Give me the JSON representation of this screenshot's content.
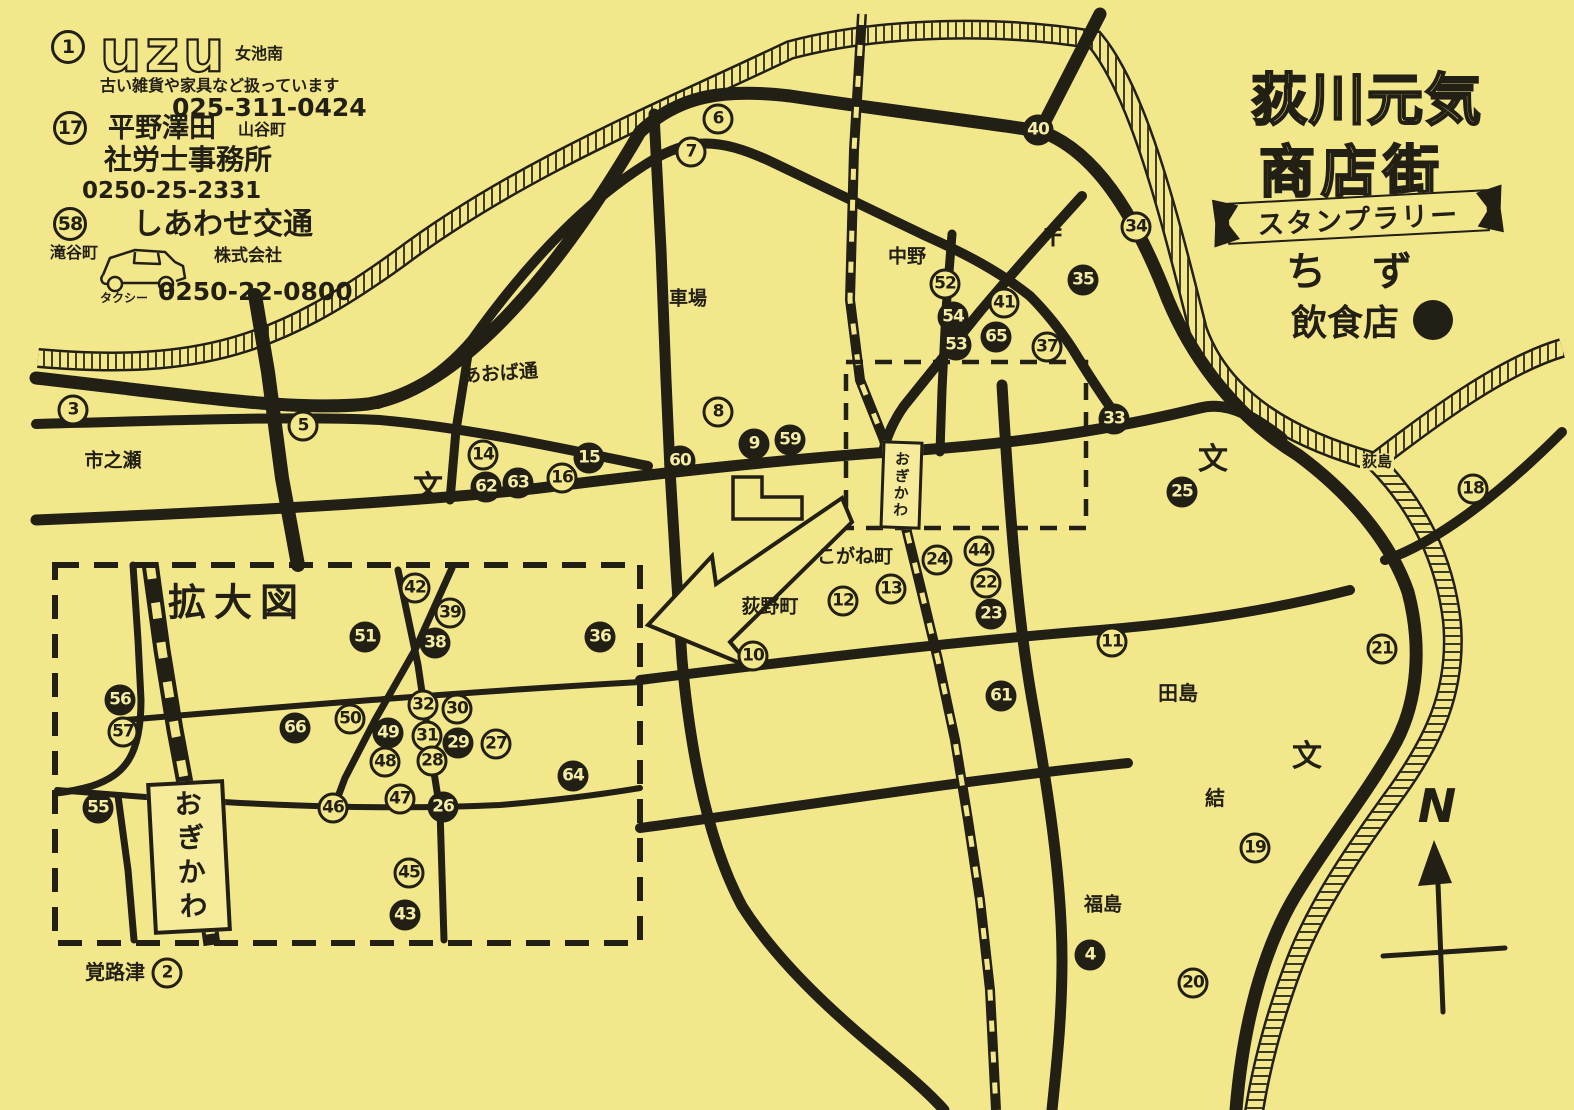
{
  "page": {
    "paper_color": "#f3e78c",
    "ink_color": "#221f14"
  },
  "title": {
    "line1": "荻川元気",
    "line2": "商店街",
    "banner": "スタンプラリー",
    "subtitle": "ちず"
  },
  "legend": {
    "label": "飲食店",
    "symbol": "filled-circle",
    "meaning": "restaurant"
  },
  "ads": [
    {
      "number": "1",
      "logo": "uzu",
      "area": "女池南",
      "desc": "古い雑貨や家具など扱っています",
      "phone": "025-311-0424"
    },
    {
      "number": "17",
      "name1": "平野澤田",
      "area": "山谷町",
      "name2": "社労士事務所",
      "phone": "0250-25-2331"
    },
    {
      "number": "58",
      "name": "しあわせ交通",
      "suffix": "株式会社",
      "area": "滝谷町",
      "vehicle": "タクシー",
      "phone": "0250-22-0800"
    }
  ],
  "station": {
    "name": "おぎかわ"
  },
  "inset": {
    "title": "拡大図"
  },
  "compass": {
    "label": "N"
  },
  "places": [
    {
      "t": "市之瀬",
      "x": 113,
      "y": 461,
      "s": 19
    },
    {
      "t": "あおば通",
      "x": 500,
      "y": 374,
      "s": 19,
      "r": -4
    },
    {
      "t": "車場",
      "x": 688,
      "y": 299,
      "s": 19
    },
    {
      "t": "中野",
      "x": 907,
      "y": 257,
      "s": 19
    },
    {
      "t": "〒",
      "x": 1053,
      "y": 238,
      "s": 24
    },
    {
      "t": "こがね町",
      "x": 855,
      "y": 557,
      "s": 19
    },
    {
      "t": "荻野町",
      "x": 770,
      "y": 607,
      "s": 19
    },
    {
      "t": "田島",
      "x": 1178,
      "y": 693,
      "s": 20
    },
    {
      "t": "結",
      "x": 1215,
      "y": 798,
      "s": 20
    },
    {
      "t": "福島",
      "x": 1103,
      "y": 905,
      "s": 19
    },
    {
      "t": "荻島",
      "x": 1377,
      "y": 462,
      "s": 15,
      "halo": true
    },
    {
      "t": "覚路津",
      "x": 115,
      "y": 972,
      "s": 20
    },
    {
      "t": "文",
      "x": 428,
      "y": 488,
      "s": 30
    },
    {
      "t": "文",
      "x": 1213,
      "y": 460,
      "s": 30
    },
    {
      "t": "文",
      "x": 1307,
      "y": 757,
      "s": 30
    }
  ],
  "stamps": [
    {
      "n": "1",
      "x": 68,
      "y": 47,
      "filled": false,
      "big": true
    },
    {
      "n": "17",
      "x": 70,
      "y": 128,
      "filled": false,
      "big": true
    },
    {
      "n": "58",
      "x": 70,
      "y": 224,
      "filled": false,
      "big": true
    },
    {
      "n": "3",
      "x": 73,
      "y": 410,
      "filled": false
    },
    {
      "n": "5",
      "x": 303,
      "y": 426,
      "filled": false
    },
    {
      "n": "6",
      "x": 718,
      "y": 119,
      "filled": false
    },
    {
      "n": "7",
      "x": 691,
      "y": 152,
      "filled": false
    },
    {
      "n": "40",
      "x": 1038,
      "y": 130,
      "filled": true
    },
    {
      "n": "34",
      "x": 1136,
      "y": 227,
      "filled": false
    },
    {
      "n": "35",
      "x": 1083,
      "y": 280,
      "filled": true
    },
    {
      "n": "52",
      "x": 945,
      "y": 284,
      "filled": false
    },
    {
      "n": "41",
      "x": 1004,
      "y": 303,
      "filled": false
    },
    {
      "n": "54",
      "x": 953,
      "y": 317,
      "filled": true
    },
    {
      "n": "65",
      "x": 996,
      "y": 337,
      "filled": true
    },
    {
      "n": "53",
      "x": 956,
      "y": 345,
      "filled": true
    },
    {
      "n": "37",
      "x": 1047,
      "y": 347,
      "filled": false
    },
    {
      "n": "8",
      "x": 718,
      "y": 412,
      "filled": false
    },
    {
      "n": "33",
      "x": 1114,
      "y": 419,
      "filled": true
    },
    {
      "n": "9",
      "x": 754,
      "y": 444,
      "filled": true
    },
    {
      "n": "59",
      "x": 790,
      "y": 440,
      "filled": true
    },
    {
      "n": "14",
      "x": 483,
      "y": 455,
      "filled": false
    },
    {
      "n": "15",
      "x": 589,
      "y": 458,
      "filled": true
    },
    {
      "n": "60",
      "x": 680,
      "y": 461,
      "filled": true
    },
    {
      "n": "16",
      "x": 562,
      "y": 478,
      "filled": false
    },
    {
      "n": "63",
      "x": 518,
      "y": 483,
      "filled": true
    },
    {
      "n": "62",
      "x": 486,
      "y": 487,
      "filled": true
    },
    {
      "n": "25",
      "x": 1182,
      "y": 492,
      "filled": true
    },
    {
      "n": "18",
      "x": 1473,
      "y": 489,
      "filled": false
    },
    {
      "n": "44",
      "x": 979,
      "y": 551,
      "filled": false
    },
    {
      "n": "24",
      "x": 937,
      "y": 560,
      "filled": false
    },
    {
      "n": "22",
      "x": 986,
      "y": 583,
      "filled": false
    },
    {
      "n": "13",
      "x": 891,
      "y": 589,
      "filled": false
    },
    {
      "n": "12",
      "x": 843,
      "y": 601,
      "filled": false
    },
    {
      "n": "23",
      "x": 991,
      "y": 614,
      "filled": true
    },
    {
      "n": "11",
      "x": 1112,
      "y": 642,
      "filled": false
    },
    {
      "n": "21",
      "x": 1382,
      "y": 649,
      "filled": false
    },
    {
      "n": "10",
      "x": 753,
      "y": 656,
      "filled": false
    },
    {
      "n": "61",
      "x": 1001,
      "y": 696,
      "filled": true
    },
    {
      "n": "19",
      "x": 1255,
      "y": 848,
      "filled": false
    },
    {
      "n": "4",
      "x": 1090,
      "y": 955,
      "filled": true
    },
    {
      "n": "20",
      "x": 1193,
      "y": 983,
      "filled": false
    },
    {
      "n": "2",
      "x": 167,
      "y": 973,
      "filled": false
    },
    {
      "n": "42",
      "x": 415,
      "y": 588,
      "filled": false
    },
    {
      "n": "39",
      "x": 450,
      "y": 613,
      "filled": false
    },
    {
      "n": "51",
      "x": 365,
      "y": 637,
      "filled": true
    },
    {
      "n": "38",
      "x": 435,
      "y": 643,
      "filled": true
    },
    {
      "n": "36",
      "x": 600,
      "y": 637,
      "filled": true
    },
    {
      "n": "56",
      "x": 120,
      "y": 700,
      "filled": true
    },
    {
      "n": "32",
      "x": 423,
      "y": 705,
      "filled": false
    },
    {
      "n": "30",
      "x": 457,
      "y": 709,
      "filled": false
    },
    {
      "n": "50",
      "x": 350,
      "y": 719,
      "filled": false
    },
    {
      "n": "66",
      "x": 295,
      "y": 728,
      "filled": true
    },
    {
      "n": "57",
      "x": 123,
      "y": 732,
      "filled": false
    },
    {
      "n": "49",
      "x": 388,
      "y": 733,
      "filled": true
    },
    {
      "n": "31",
      "x": 427,
      "y": 736,
      "filled": false
    },
    {
      "n": "29",
      "x": 458,
      "y": 743,
      "filled": true
    },
    {
      "n": "27",
      "x": 496,
      "y": 744,
      "filled": false
    },
    {
      "n": "28",
      "x": 432,
      "y": 761,
      "filled": false
    },
    {
      "n": "48",
      "x": 385,
      "y": 762,
      "filled": false
    },
    {
      "n": "64",
      "x": 573,
      "y": 776,
      "filled": true
    },
    {
      "n": "47",
      "x": 400,
      "y": 799,
      "filled": false
    },
    {
      "n": "55",
      "x": 98,
      "y": 808,
      "filled": true
    },
    {
      "n": "46",
      "x": 333,
      "y": 808,
      "filled": false
    },
    {
      "n": "26",
      "x": 443,
      "y": 807,
      "filled": true
    },
    {
      "n": "45",
      "x": 409,
      "y": 873,
      "filled": false
    },
    {
      "n": "43",
      "x": 405,
      "y": 915,
      "filled": true
    }
  ]
}
